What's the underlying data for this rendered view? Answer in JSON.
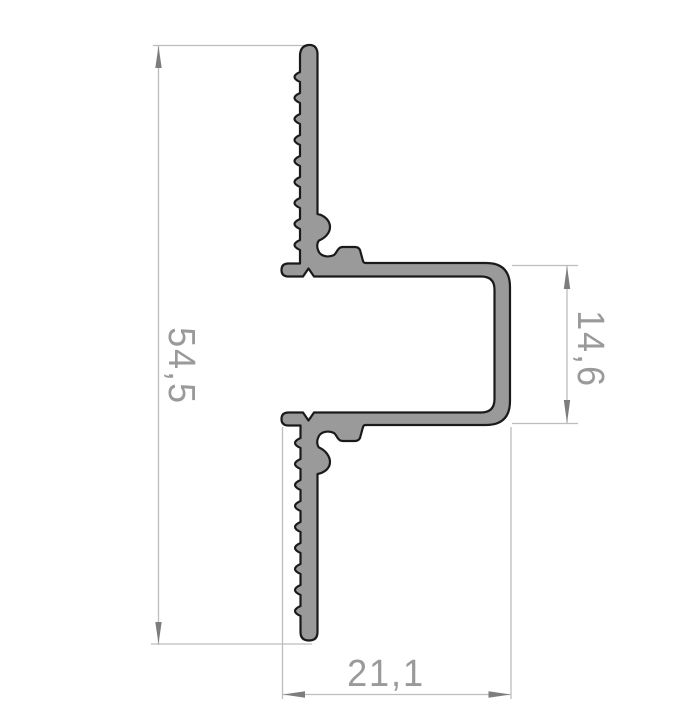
{
  "drawing": {
    "title": "aluminium-profile-cross-section",
    "dimensions": {
      "overall_height": {
        "value": "54,5",
        "orientation": "vertical",
        "side": "left"
      },
      "channel_height": {
        "value": "14,6",
        "orientation": "vertical",
        "side": "right"
      },
      "overall_width": {
        "value": "21,1",
        "orientation": "horizontal",
        "side": "bottom"
      }
    },
    "colors": {
      "background": "#ffffff",
      "profile_fill": "#9a9a9a",
      "profile_outline": "#1a1a1a",
      "dimension_line": "#bdbdbd",
      "dimension_arrow": "#7d7d7d",
      "dimension_text": "#9a9a9a"
    }
  }
}
